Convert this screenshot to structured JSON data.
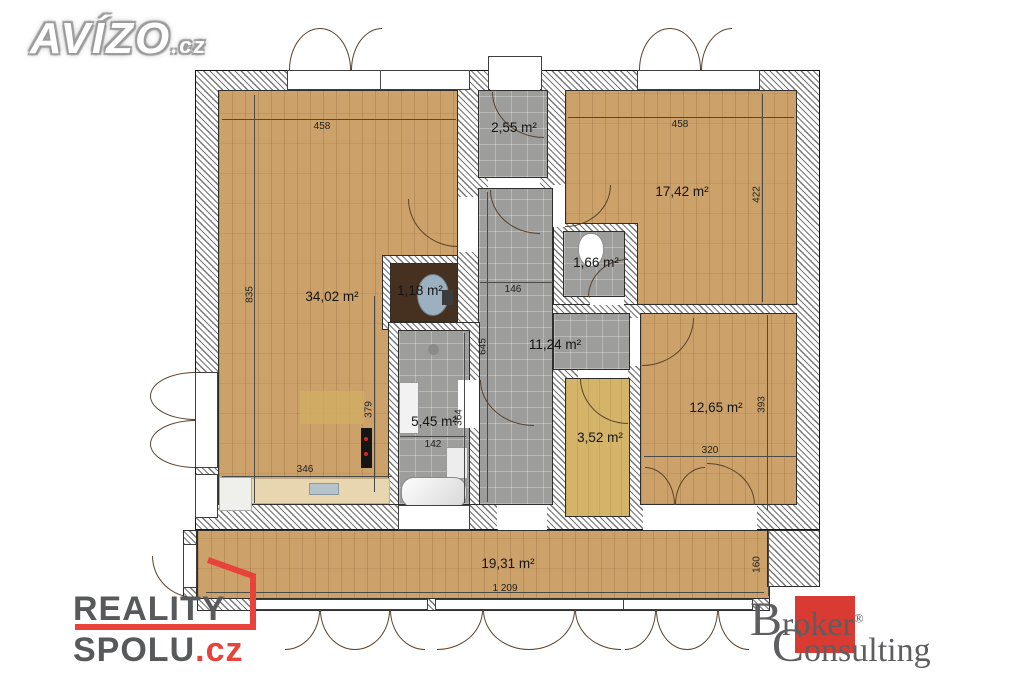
{
  "branding": {
    "avizo": {
      "name": "AVÍZO",
      "tld": ".cz"
    },
    "reality": {
      "line1": "REALITY",
      "line2": "SPOLU",
      "tld": ".cz"
    },
    "broker": {
      "word1": "Broker",
      "reg": "®",
      "word2": "Consulting"
    }
  },
  "colors": {
    "wood_floor": "#cda26a",
    "tile_floor": "#9d9d9b",
    "closet_floor": "#d4b469",
    "wc_floor": "#463020",
    "accent_red": "#e8433a",
    "logo_gray": "#58595a"
  },
  "rooms": {
    "living": {
      "area": "34,02 m²"
    },
    "entry": {
      "area": "2,55 m²"
    },
    "bedroom1": {
      "area": "17,42 m²"
    },
    "wc_small": {
      "area": "1,66 m²"
    },
    "wc_tiny": {
      "area": "1,18 m²"
    },
    "hall": {
      "area": "11,24 m²"
    },
    "bathroom": {
      "area": "5,45 m²"
    },
    "bedroom2": {
      "area": "12,65 m²"
    },
    "closet": {
      "area": "3,52 m²"
    },
    "balcony": {
      "area": "19,31 m²"
    }
  },
  "dims": {
    "living_w": "458",
    "living_h": "835",
    "kitchen_w": "346",
    "kitchen_h": "379",
    "bedroom1_w": "458",
    "bedroom1_h": "422",
    "hall_w": "146",
    "hall_h": "645",
    "bath_w": "142",
    "bath_h": "364",
    "bedroom2_w": "320",
    "bedroom2_h": "393",
    "balcony_w": "1 209",
    "balcony_h": "160"
  }
}
